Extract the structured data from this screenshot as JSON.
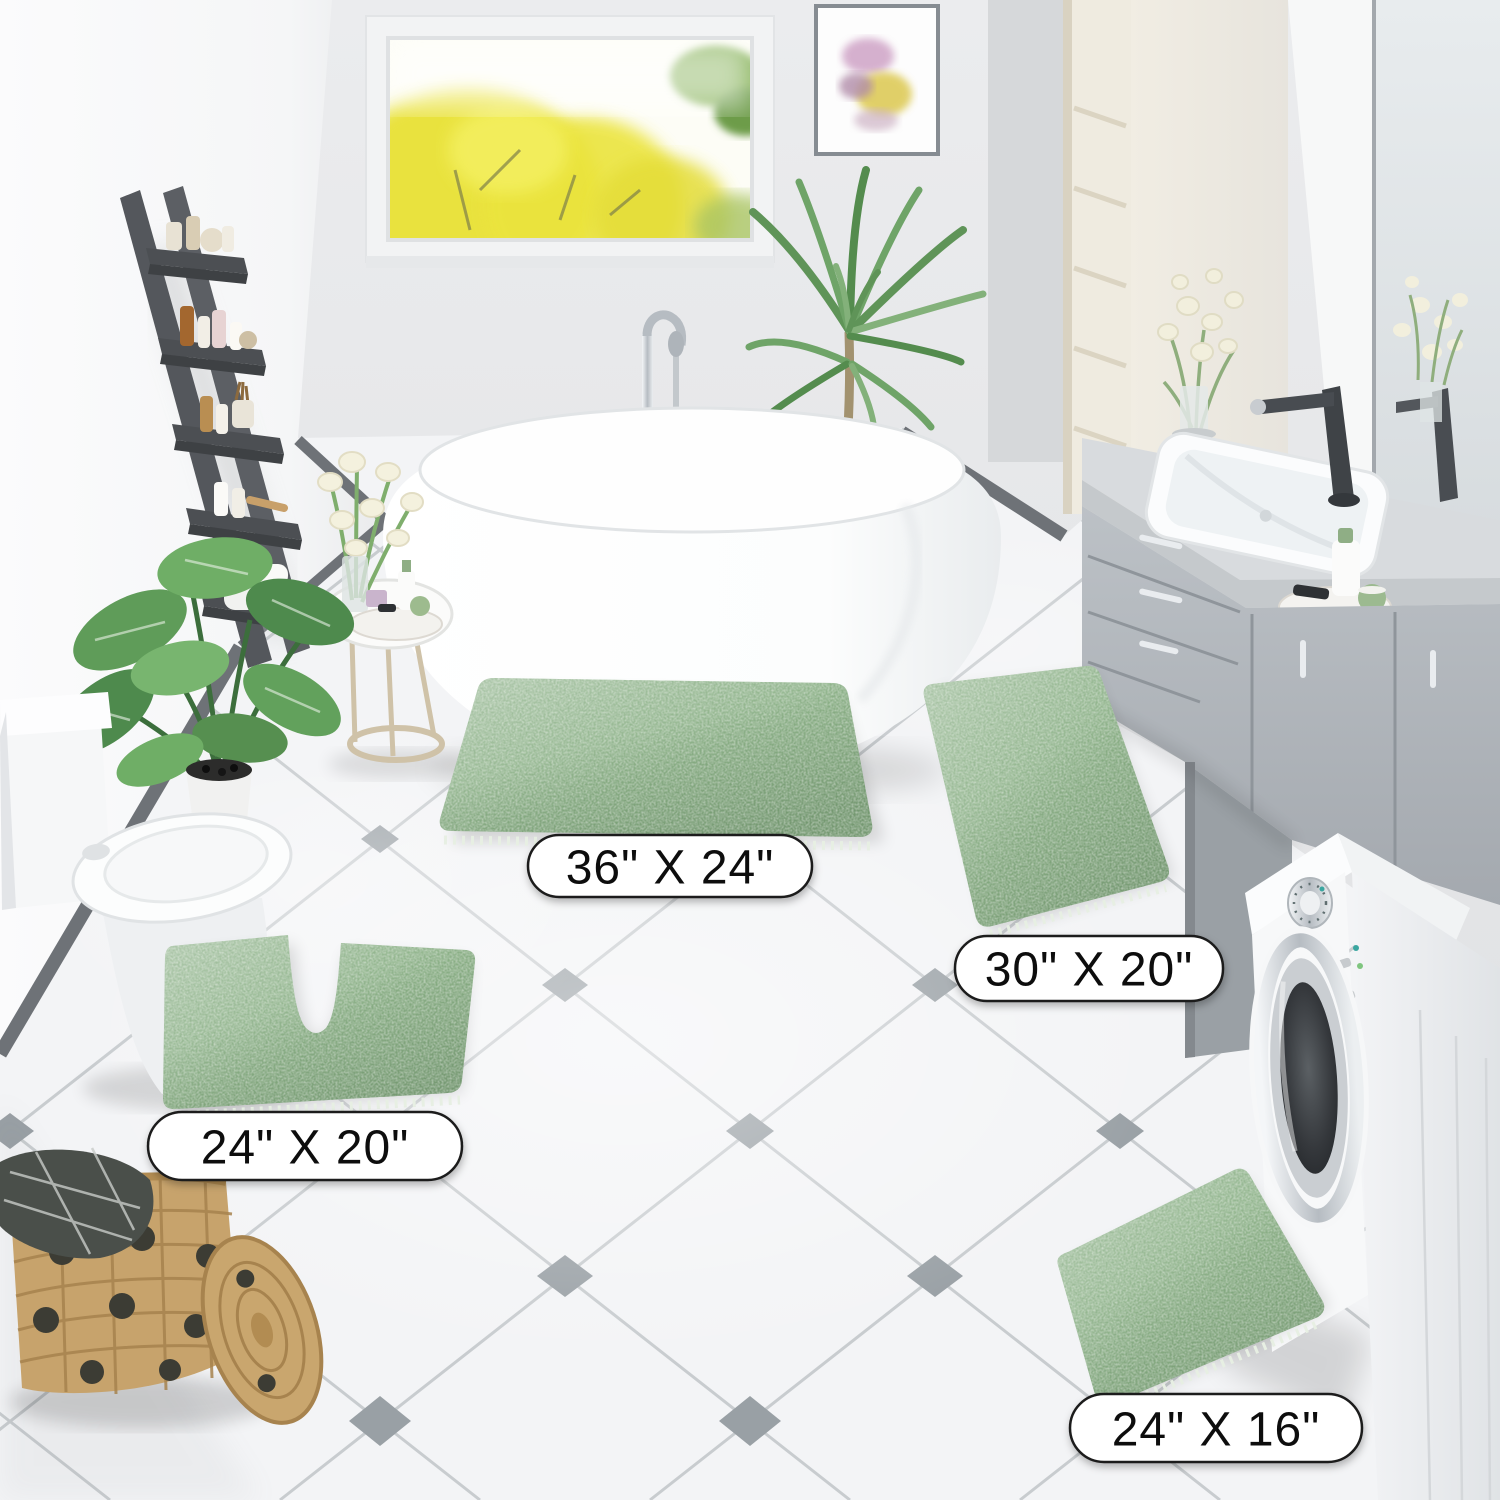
{
  "size_labels": [
    {
      "id": "rug-36x24",
      "text": "36\" X 24\""
    },
    {
      "id": "rug-30x20",
      "text": "30\" X 20\""
    },
    {
      "id": "rug-contour-24x20",
      "text": "24\" X 20\""
    },
    {
      "id": "rug-24x16",
      "text": "24\" X 16\""
    }
  ],
  "colors": {
    "rug_green": "#8FB48A",
    "rug_green_deep": "#76A072",
    "label_bg": "#FFFFFF",
    "label_border": "#1B1B1B",
    "label_text": "#111111",
    "floor_tile": "#F3F4F6",
    "tile_line": "#C6CACD",
    "tile_inset": "#99A0A5",
    "wall_gray": "#E7E8EA",
    "baseboard_gray": "#6E7277",
    "ladder_gray": "#54575C",
    "vanity_gray": "#B2B7BD",
    "faucet_black": "#3F4347",
    "cream_cabinet": "#EFEBE0",
    "basket_tan": "#C7A36C",
    "plant_green": "#5F9C59",
    "window_foliage_yellow": "#E8E135"
  }
}
